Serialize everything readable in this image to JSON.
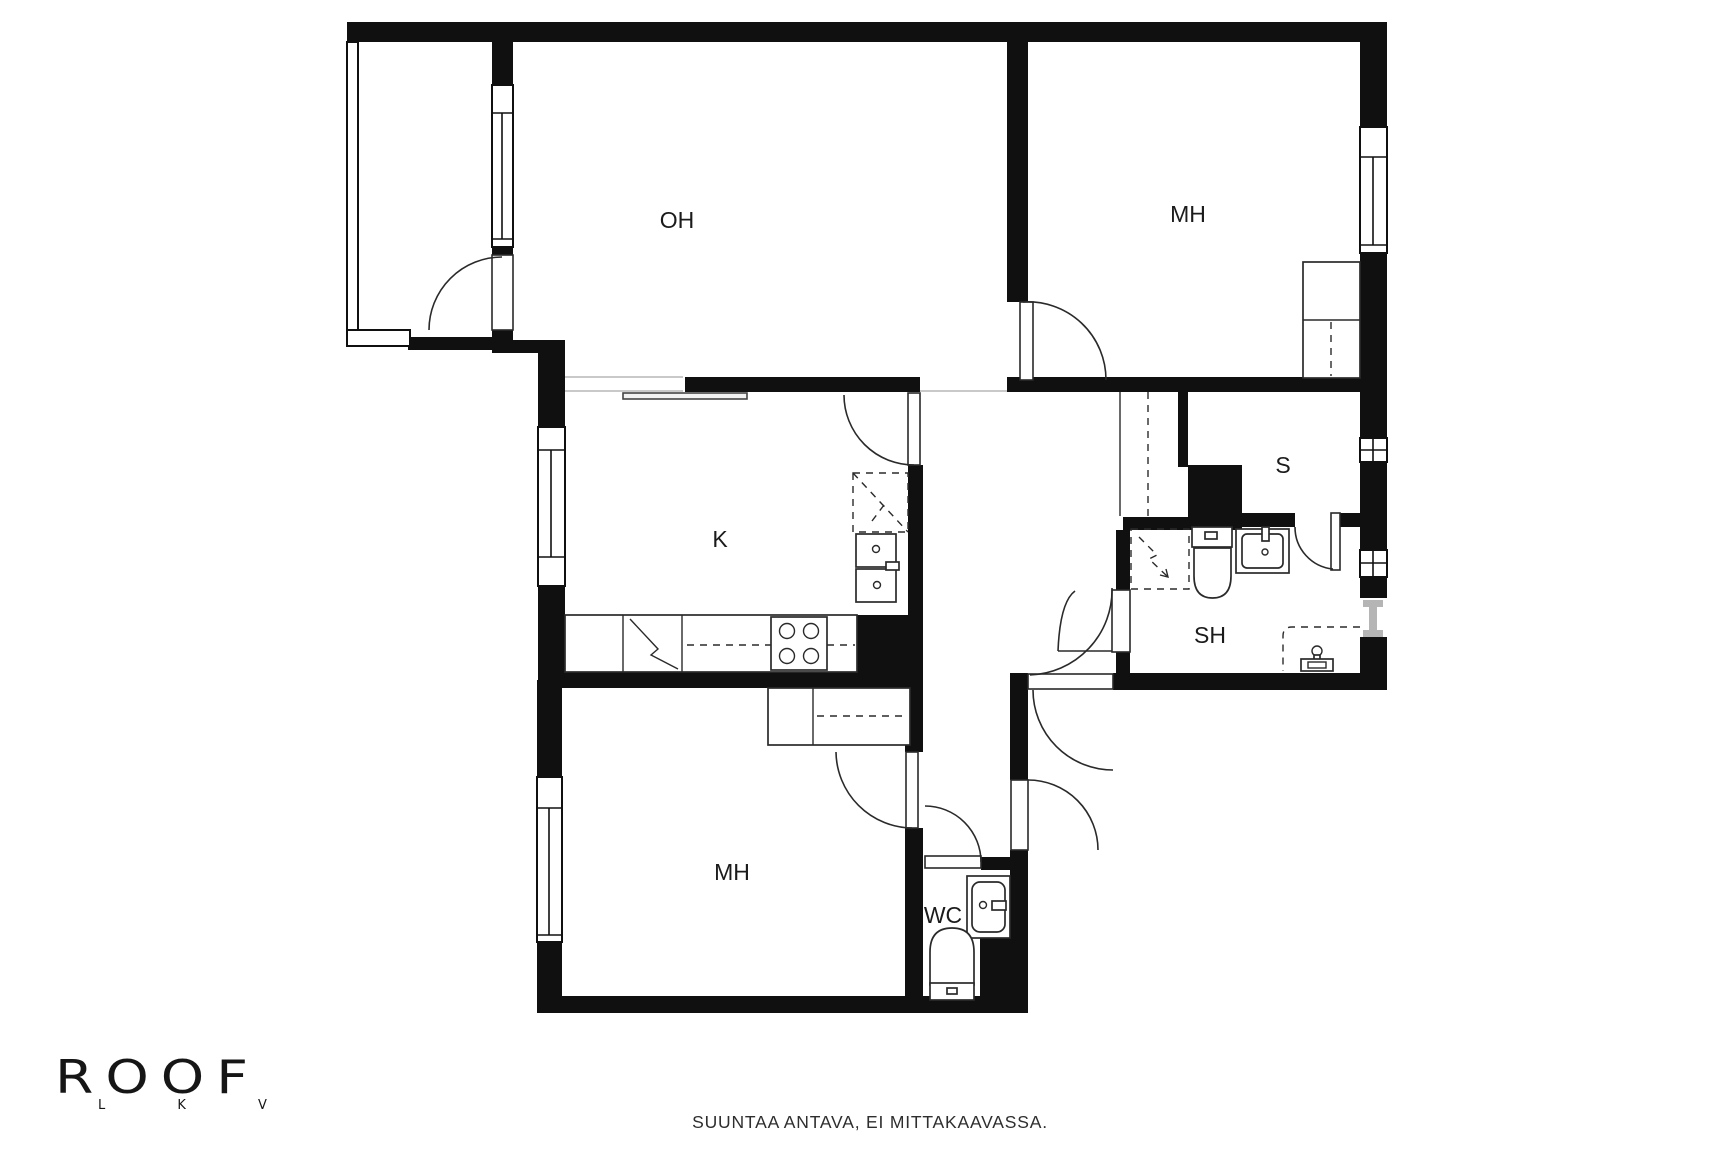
{
  "canvas": {
    "width": 1730,
    "height": 1150,
    "background": "#ffffff"
  },
  "rooms": [
    {
      "id": "oh",
      "label": "OH"
    },
    {
      "id": "mh_top",
      "label": "MH"
    },
    {
      "id": "kitchen",
      "label": "K"
    },
    {
      "id": "sauna",
      "label": "S"
    },
    {
      "id": "shower",
      "label": "SH"
    },
    {
      "id": "mh_bottom",
      "label": "MH"
    },
    {
      "id": "wc",
      "label": "WC"
    }
  ],
  "branding": {
    "logo": "ROOF",
    "logo_sub": "L K V"
  },
  "footer": {
    "disclaimer": "SUUNTAA ANTAVA, EI MITTAKAAVASSA."
  },
  "palette": {
    "wall": "#101010",
    "fixture_line": "#2a2a2a",
    "faint_line": "#c9c9c9",
    "watermark": "#b5b5b5",
    "background": "#ffffff"
  }
}
